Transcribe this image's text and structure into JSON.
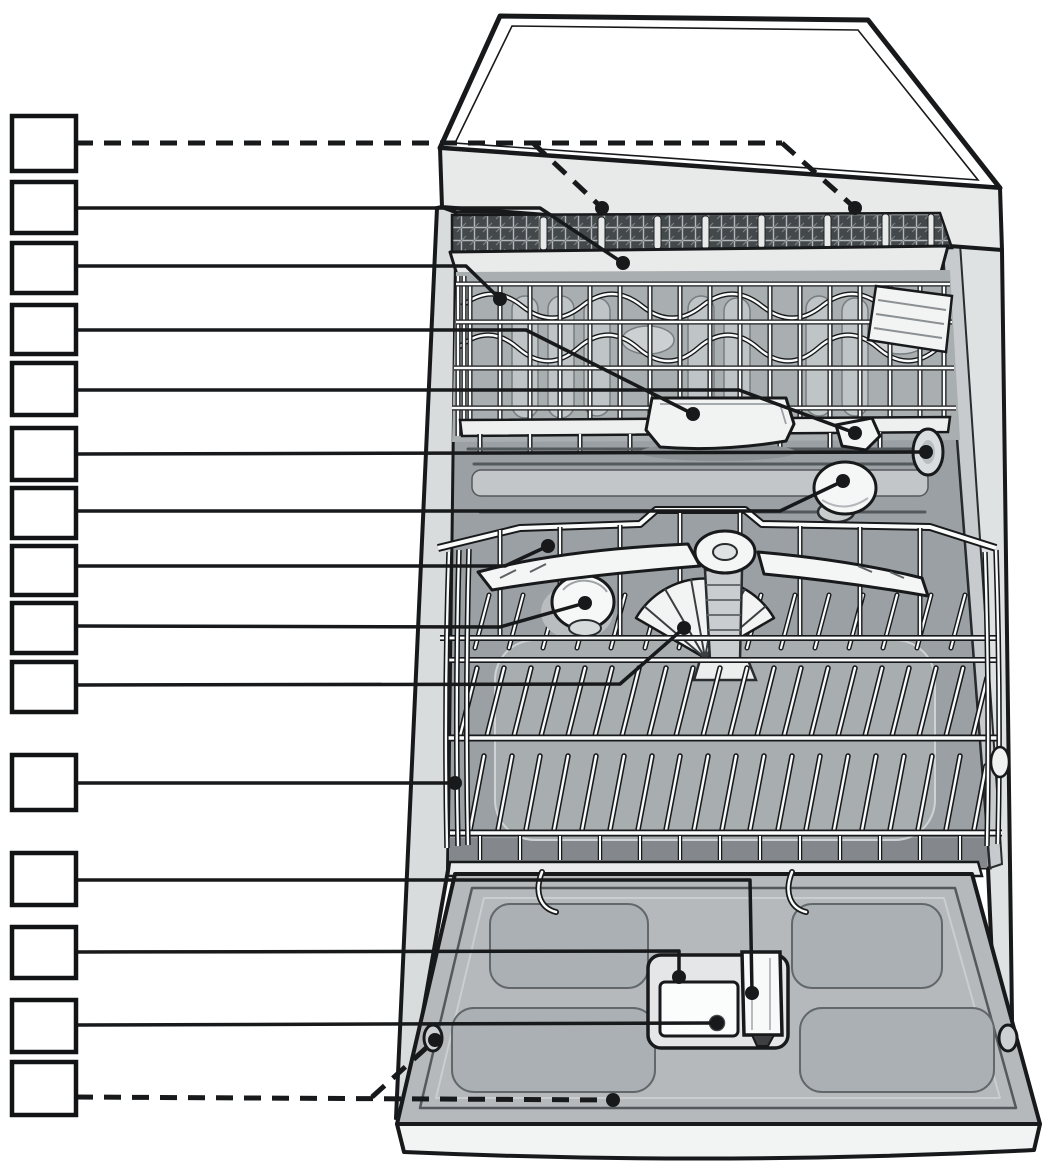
{
  "figure": {
    "kind": "appliance-parts-diagram",
    "subject": "dishwasher-interior-overview",
    "canvas": {
      "width": 1042,
      "height": 1165
    },
    "colors": {
      "background": "#ffffff",
      "line": "#17191b",
      "box_fill": "#ffffff",
      "box_stroke": "#111315",
      "tub": "#9aa0a4",
      "door": "#b5b9bc",
      "worktop_face": "#e8eaea",
      "white_part": "#f5f7f7"
    },
    "callouts": [
      {
        "id": 1,
        "label": "",
        "target_part": "cutlery-drawer-top-rack",
        "style": "dashed",
        "box": {
          "x": 12,
          "y": 116,
          "w": 64,
          "h": 55
        },
        "lines": [
          [
            [
              76,
              143
            ],
            [
              782,
              143
            ]
          ],
          [
            [
              533,
              143
            ],
            [
              602,
              208
            ]
          ],
          [
            [
              782,
              143
            ],
            [
              855,
              208
            ]
          ]
        ],
        "dots": [
          [
            602,
            208
          ],
          [
            855,
            208
          ]
        ]
      },
      {
        "id": 2,
        "label": "",
        "target_part": "cutlery-drawer-front-rim",
        "style": "solid",
        "box": {
          "x": 12,
          "y": 182,
          "w": 64,
          "h": 51
        },
        "lines": [
          [
            [
              76,
              208
            ],
            [
              540,
              208
            ],
            [
              623,
              263
            ]
          ]
        ],
        "dots": [
          [
            623,
            263
          ]
        ]
      },
      {
        "id": 3,
        "label": "",
        "target_part": "upper-basket",
        "style": "solid",
        "box": {
          "x": 12,
          "y": 243,
          "w": 64,
          "h": 50
        },
        "lines": [
          [
            [
              76,
              266
            ],
            [
              466,
              266
            ],
            [
              500,
              299
            ]
          ]
        ],
        "dots": [
          [
            500,
            299
          ]
        ]
      },
      {
        "id": 4,
        "label": "",
        "target_part": "tablet-collecting-tray",
        "style": "solid",
        "box": {
          "x": 12,
          "y": 305,
          "w": 64,
          "h": 49
        },
        "lines": [
          [
            [
              76,
              330
            ],
            [
              526,
              330
            ],
            [
              693,
              414
            ]
          ]
        ],
        "dots": [
          [
            693,
            414
          ]
        ]
      },
      {
        "id": 5,
        "label": "",
        "target_part": "top-spray-arm",
        "style": "solid",
        "box": {
          "x": 12,
          "y": 363,
          "w": 64,
          "h": 52
        },
        "lines": [
          [
            [
              76,
              390
            ],
            [
              739,
              390
            ],
            [
              855,
              433
            ]
          ]
        ],
        "dots": [
          [
            855,
            433
          ]
        ]
      },
      {
        "id": 6,
        "label": "",
        "target_part": "side-wall-sensor-opening",
        "style": "solid",
        "box": {
          "x": 12,
          "y": 428,
          "w": 64,
          "h": 52
        },
        "lines": [
          [
            [
              76,
              454
            ],
            [
              926,
              452
            ]
          ]
        ],
        "dots": [
          [
            926,
            452
          ]
        ]
      },
      {
        "id": 7,
        "label": "",
        "target_part": "rear-water-feed-knob",
        "style": "solid",
        "box": {
          "x": 12,
          "y": 488,
          "w": 64,
          "h": 50
        },
        "lines": [
          [
            [
              76,
              511
            ],
            [
              780,
              511
            ],
            [
              843,
              481
            ]
          ]
        ],
        "dots": [
          [
            843,
            481
          ]
        ]
      },
      {
        "id": 8,
        "label": "",
        "target_part": "middle-spray-arm",
        "style": "solid",
        "box": {
          "x": 12,
          "y": 546,
          "w": 64,
          "h": 49
        },
        "lines": [
          [
            [
              76,
              566
            ],
            [
              505,
              566
            ],
            [
              548,
              546
            ]
          ]
        ],
        "dots": [
          [
            548,
            546
          ]
        ]
      },
      {
        "id": 9,
        "label": "",
        "target_part": "salt-dispenser-cap",
        "style": "solid",
        "box": {
          "x": 12,
          "y": 603,
          "w": 64,
          "h": 50
        },
        "lines": [
          [
            [
              76,
              626
            ],
            [
              500,
              627
            ],
            [
              585,
              603
            ]
          ]
        ],
        "dots": [
          [
            585,
            603
          ]
        ]
      },
      {
        "id": 10,
        "label": "",
        "target_part": "filter-fan-assembly",
        "style": "solid",
        "box": {
          "x": 12,
          "y": 662,
          "w": 64,
          "h": 50
        },
        "lines": [
          [
            [
              76,
              685
            ],
            [
              620,
              684
            ],
            [
              684,
              628
            ]
          ]
        ],
        "dots": [
          [
            684,
            628
          ]
        ]
      },
      {
        "id": 11,
        "label": "",
        "target_part": "lower-basket",
        "style": "solid",
        "box": {
          "x": 12,
          "y": 755,
          "w": 64,
          "h": 55
        },
        "lines": [
          [
            [
              76,
              783
            ],
            [
              455,
              783
            ]
          ]
        ],
        "dots": [
          [
            455,
            783
          ]
        ]
      },
      {
        "id": 12,
        "label": "",
        "target_part": "dispenser-tablet-slot",
        "style": "solid",
        "box": {
          "x": 12,
          "y": 853,
          "w": 64,
          "h": 52
        },
        "lines": [
          [
            [
              76,
              880
            ],
            [
              750,
              880
            ],
            [
              752,
              993
            ]
          ]
        ],
        "dots": [
          [
            752,
            993
          ]
        ]
      },
      {
        "id": 13,
        "label": "",
        "target_part": "detergent-dispenser",
        "style": "solid",
        "box": {
          "x": 12,
          "y": 927,
          "w": 64,
          "h": 51
        },
        "lines": [
          [
            [
              76,
              952
            ],
            [
              679,
              951
            ],
            [
              679,
              977
            ]
          ]
        ],
        "dots": [
          [
            679,
            977
          ]
        ]
      },
      {
        "id": 14,
        "label": "",
        "target_part": "dispenser-release-button",
        "style": "solid",
        "box": {
          "x": 12,
          "y": 1000,
          "w": 64,
          "h": 52
        },
        "lines": [
          [
            [
              76,
              1025
            ],
            [
              717,
              1023
            ]
          ]
        ],
        "dots": [
          [
            717,
            1023
          ]
        ]
      },
      {
        "id": 15,
        "label": "",
        "target_part": "inner-door-panel",
        "style": "dashed",
        "box": {
          "x": 12,
          "y": 1062,
          "w": 64,
          "h": 53
        },
        "lines": [
          [
            [
              76,
              1097
            ],
            [
              613,
              1100
            ]
          ],
          [
            [
              372,
              1097
            ],
            [
              435,
              1040
            ]
          ]
        ],
        "dots": [
          [
            613,
            1100
          ],
          [
            435,
            1040
          ]
        ]
      }
    ]
  }
}
